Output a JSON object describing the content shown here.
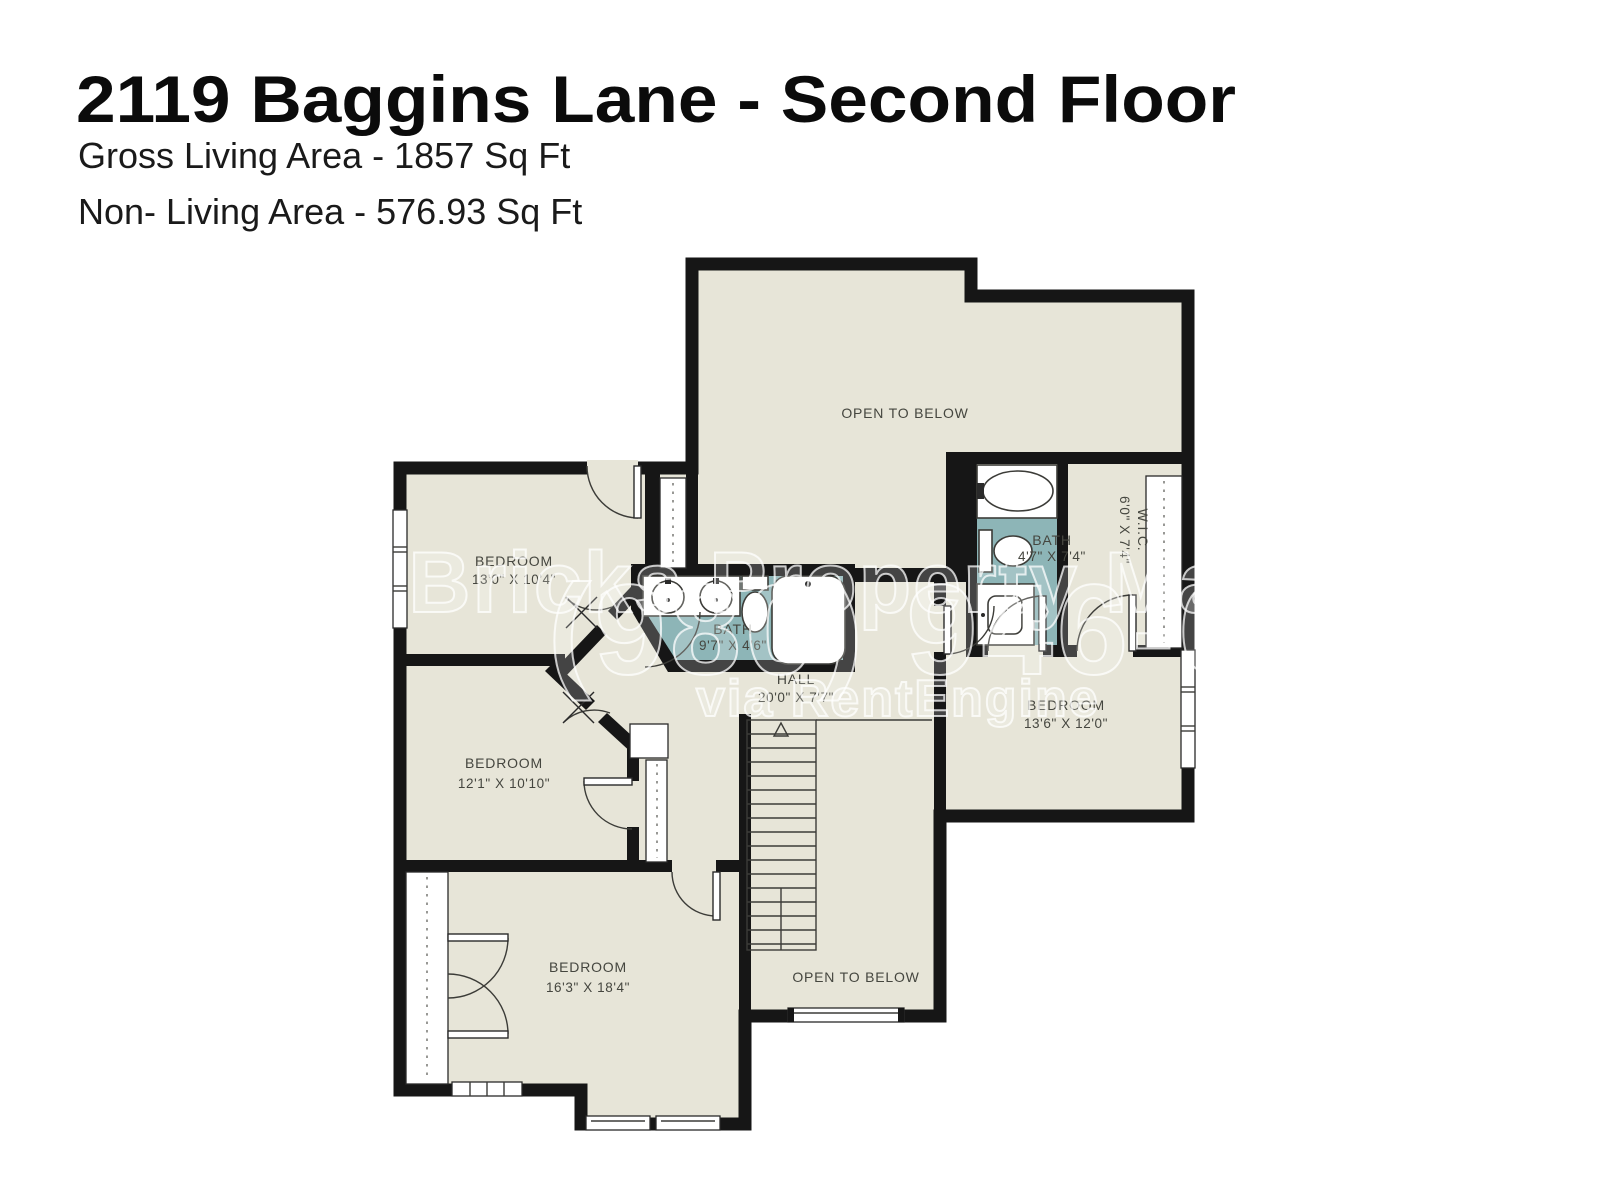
{
  "header": {
    "title": "2119 Baggins Lane - Second Floor",
    "gross_living": "Gross Living Area - 1857 Sq Ft",
    "non_living": "Non- Living Area - 576.93 Sq Ft"
  },
  "rooms": {
    "open_to_below_top": "OPEN TO BELOW",
    "open_to_below_bottom": "OPEN TO BELOW",
    "bedroom_top_left": {
      "name": "BEDROOM",
      "dims": "13'0\" X 10'4\""
    },
    "bedroom_mid_left": {
      "name": "BEDROOM",
      "dims": "12'1\" X 10'10\""
    },
    "bedroom_bottom": {
      "name": "BEDROOM",
      "dims": "16'3\" X 18'4\""
    },
    "bedroom_right": {
      "name": "BEDROOM",
      "dims": "13'6\" X 12'0\""
    },
    "bath_center": {
      "name": "BATH",
      "dims": "9'7\" X 4'6\""
    },
    "bath_right": {
      "name": "BATH",
      "dims": "4'7\" X 7'4\""
    },
    "wic": {
      "name": "W.I.C.",
      "dims": "6'0\" X 7'4\""
    },
    "hall": {
      "name": "HALL",
      "dims": "20'0\" X 7'7\""
    }
  },
  "watermark": {
    "line1": "d Bricks Property Management L",
    "line2": "(980) 946-6773",
    "line3": "via RentEngine"
  },
  "colors": {
    "floor": "#e7e5d8",
    "wall": "#161616",
    "bath_floor": "#8db5b7",
    "label": "#45463f"
  }
}
